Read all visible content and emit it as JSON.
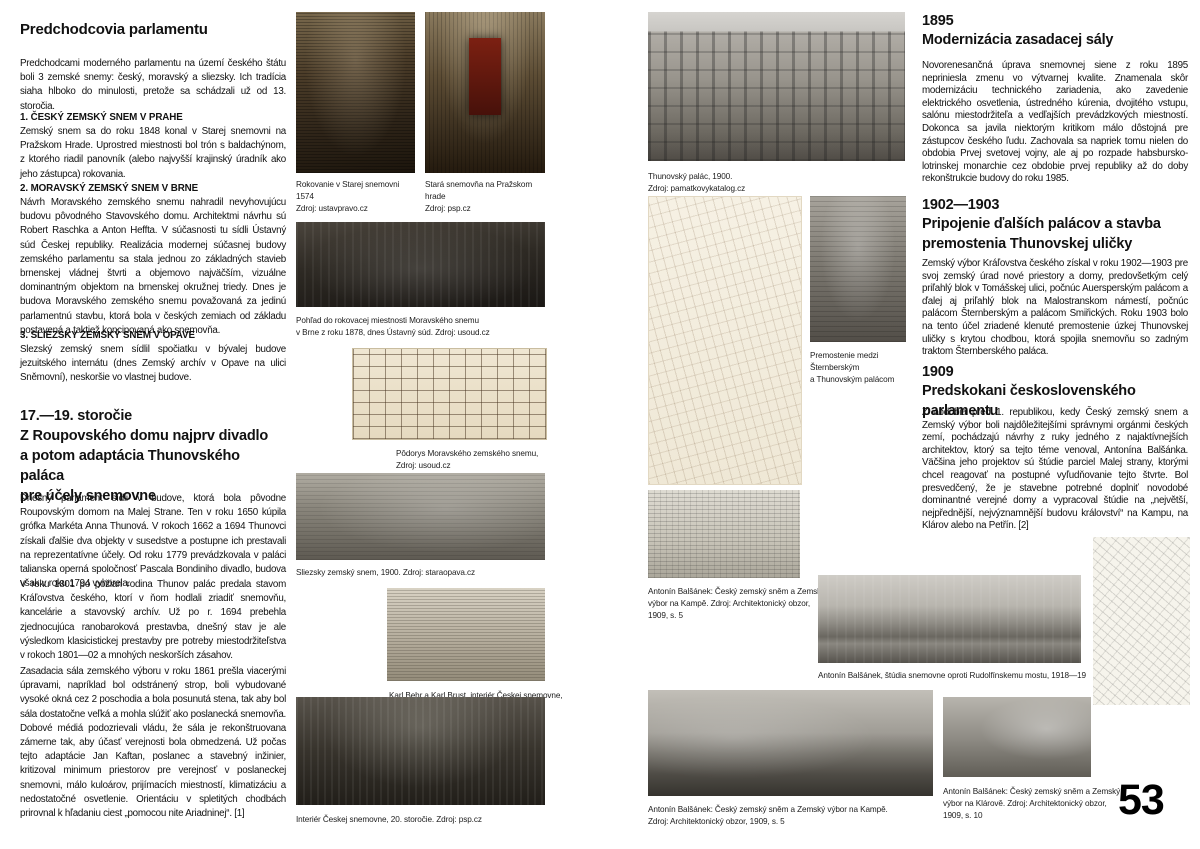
{
  "page": {
    "number": "53"
  },
  "left_column": {
    "title": "Predchodcovia parlamentu",
    "intro": "Predchodcami moderného parlamentu na území českého štátu boli 3 zemské snemy: český, moravský a sliezsky. Ich tradícia siaha hlboko do minulosti, pretože sa schádzali už od 13. storočia.",
    "subsections": [
      {
        "title": "1. ČESKÝ ZEMSKÝ SNEM V PRAHE",
        "body": "Zemský snem sa do roku 1848 konal v Starej snemovni na Pražskom Hrade. Uprostred miestnosti bol trón s baldachýnom, z ktorého riadil panovník (alebo najvyšší krajinský úradník ako jeho zástupca) rokovania."
      },
      {
        "title": "2. MORAVSKÝ ZEMSKÝ SNEM V BRNE",
        "body": "Návrh Moravského zemského snemu nahradil nevyhovujúcu budovu pôvodného Stavovského domu. Architektmi návrhu sú Robert Raschka a Anton Heffta. V súčasnosti tu sídli Ústavný súd Českej republiky. Realizácia modernej súčasnej budovy zemského parlamentu sa stala jednou zo základných stavieb brnenskej vládnej štvrti a objemovo najväčším, vizuálne dominantným objektom na brnenskej okružnej triedy. Dnes je budova Moravského zemského snemu považovaná za jedinú parlamentnú stavbu, ktorá bola v českých zemiach od základu postavená a taktiež koncipovaná ako snemovňa."
      },
      {
        "title": "3. SLIEZSKY ZEMSKÝ SNEM V OPAVE",
        "body": "Slezský zemský snem sídlil spočiatku v bývalej budove jezuitského internátu (dnes Zemský archív v Opave na ulici Sněmovní), neskoršie vo vlastnej budove."
      }
    ],
    "section2": {
      "heading_lines": [
        "17.—19. storočie",
        "Z Roupovského domu najprv divadlo",
        "a potom adaptácia Thunovského paláca",
        "pre účely snemovne"
      ],
      "paragraphs": [
        "Dnešný parlament sídli v budove, ktorá bola pôvodne Roupovským domom na Malej Strane. Ten v roku 1650 kúpila grófka Markéta Anna Thunová. V rokoch 1662 a 1694 Thunovci získali ďalšie dva objekty v susedstve a postupne ich prestavali na reprezentatívne účely. Od roku 1779 prevádzkovala v paláci talianska operná spoločnosť Pascala Bondiniho divadlo, budova však v roku 1794 vyhorela.",
        "V roku 1801 po požiari rodina Thunov palác predala stavom Kráľovstva českého, ktorí v ňom hodlali zriadiť snemovňu, kancelárie a stavovský archív. Už po r. 1694 prebehla zjednocujúca ranobaroková prestavba, dnešný stav je ale výsledkom klasicistickej prestavby pre potreby miestodržiteľstva v rokoch 1801—02 a mnohých neskorších zásahov.",
        "Zasadacia sála zemského výboru v roku 1861 prešla viacerými úpravami, napríklad bol odstránený strop, boli vybudované vysoké okná cez 2 poschodia a bola posunutá stena, tak aby bol sála dostatočne veľká a mohla slúžiť ako poslanecká snemovňa. Dobové médiá podozrievali vládu, že sála je rekonštruovana zámerne tak, aby účasť verejnosti bola obmedzená. Už počas tejto adaptácie Jan Kaftan, poslanec a stavebný inžinier, kritizoval minimum priestorov pre verejnosť v poslaneckej snemovni, málo kuloárov, prijímacích miestností, klimatizáciu a nedostatočné osvetlenie. Orientáciu v spletitých chodbách prirovnal k hľadaniu ciest „pomocou nite Ariadninej“. [1]"
      ]
    }
  },
  "right_column": {
    "sections": [
      {
        "year": "1895",
        "heading_lines": [
          "Modernizácia zasadacej sály"
        ],
        "body": "Novorenesančná úprava snemovnej siene z roku 1895 nepriniesla zmenu vo výtvarnej kvalite. Znamenala skôr modernizáciu technického zariadenia, ako zavedenie elektrického osvetlenia, ústredného kúrenia, dvojitého vstupu, salónu miestodržiteľa a vedľajších prevádzkových miestností. Dokonca sa javila niektorým kritikom málo dôstojná pre zástupcov českého ľudu. Zachovala sa napriek tomu nielen do obdobia Prvej svetovej vojny, ale aj po rozpade habsbursko-lotrinskej monarchie cez obdobie prvej republiky až do doby rekonštrukcie budovy do roku 1985."
      },
      {
        "year": "1902—1903",
        "heading_lines": [
          "Pripojenie ďalších palácov a stavba",
          "premostenia Thunovskej uličky"
        ],
        "body": "Zemský výbor Kráľovstva českého získal v roku 1902—1903 pre svoj zemský úrad nové priestory a domy, predovšetkým celý priľahlý blok v Tomášskej ulici, počnúc Auersperským palácom a ďalej aj priľahlý blok na Malostranskom námestí, počnúc palácom Šternberským a palácom Smiřických. Roku 1903 bolo na tento účel zriadené klenuté premostenie úzkej Thunovskej uličky s krytou chodbou, ktorá spojila snemovňu so zadným traktom Šternberského paláca."
      },
      {
        "year": "1909",
        "heading_lines": [
          "Predskokani československého parlamentu"
        ],
        "body": "Z obdobia pred 1. republikou, kedy Český zemský snem a Zemský výbor boli najdôležitejšími správnymi orgánmi českých zemí, pochádzajú návrhy z ruky jedného z najaktívnejších architektov, ktorý sa tejto téme venoval, Antonína Balšánka. Väčšina jeho projektov sú štúdie parciel Malej strany, ktorými chcel reagovať na postupné vyľudňovanie tejto štvrte. Bol presvedčený, že je stavebne potrebné doplniť novodobé dominantné verejné domy a vypracoval štúdie na „největší, nejpřednější, nejvýznamnější budovu království“ na Kampu, na Klárov alebo na Petřín. [2]"
      }
    ]
  },
  "figures": {
    "session_1574": {
      "lines": [
        "Rokovanie v Starej snemovni 1574",
        "Zdroj: ustavpravo.cz"
      ]
    },
    "old_chamber": {
      "lines": [
        "Stará snemovňa na Pražskom hrade",
        "Zdroj: psp.cz"
      ]
    },
    "moravian_room": {
      "lines": [
        "Pohľad do rokovacej miestnosti Moravského snemu",
        "v Brne z roku 1878, dnes Ústavný súd. Zdroj: usoud.cz"
      ]
    },
    "moravian_plan": {
      "lines": [
        "Pôdorys Moravského zemského snemu,",
        "Zdroj: usoud.cz"
      ]
    },
    "silesian": {
      "lines": [
        "Sliezsky zemský snem, 1900. Zdroj: staraopava.cz"
      ]
    },
    "behr": {
      "lines": [
        "Karl Behr a Karl Brust, interiér Českej snemovne, 1861.",
        "Zdroj: psp.cz"
      ]
    },
    "interior20": {
      "lines": [
        "Interiér Českej snemovne, 20. storočie. Zdroj: psp.cz"
      ]
    },
    "thun_palace": {
      "lines": [
        "Thunovský palác, 1900.",
        "Zdroj: pamatkovykatalog.cz"
      ]
    },
    "bridge": {
      "lines": [
        "Premostenie medzi",
        "Šternberským",
        "a Thunovským palácom"
      ]
    },
    "kampa_drawing": {
      "lines": [
        "Antonín Balšánek: Český zemský sněm a Zemský",
        "výbor na Kampě. Zdroj: Architektonický obzor,",
        "1909, s. 5"
      ]
    },
    "rudolfinum": {
      "lines": [
        "Antonín Balšánek, štúdia snemovne oproti Rudolfínskemu mostu, 1918—19"
      ]
    },
    "kampa_pano": {
      "lines": [
        "Antonín Balšánek: Český zemský sněm a Zemský výbor na Kampě.",
        "Zdroj: Architektonický obzor, 1909, s. 5"
      ]
    },
    "klarov": {
      "lines": [
        "Antonín Balšánek: Český zemský sněm a Zemský",
        "výbor na Klárově. Zdroj: Architektonický obzor,",
        "1909, s. 10"
      ]
    }
  }
}
